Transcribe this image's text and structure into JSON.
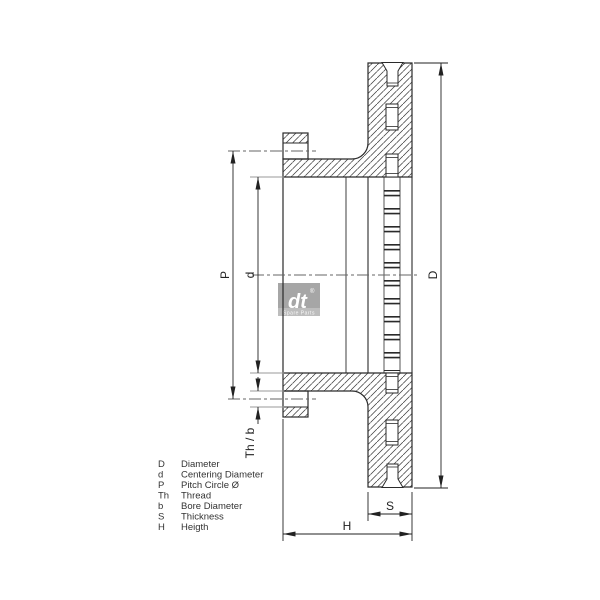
{
  "drawing_type": "brake-disc-cross-section",
  "dimensions": {
    "P": "P",
    "d": "d",
    "D": "D",
    "ThB": "Th / b",
    "S": "S",
    "H": "H"
  },
  "legend": {
    "rows": [
      {
        "key": "D",
        "label": "Diameter"
      },
      {
        "key": "d",
        "label": "Centering Diameter"
      },
      {
        "key": "P",
        "label": "Pitch Circle Ø"
      },
      {
        "key": "Th",
        "label": "Thread"
      },
      {
        "key": "b",
        "label": "Bore Diameter"
      },
      {
        "key": "S",
        "label": "Thickness"
      },
      {
        "key": "H",
        "label": "Heigth"
      }
    ]
  },
  "logo": {
    "text": "dt",
    "registered": "®",
    "caption": "Spare Parts"
  },
  "colors": {
    "outline": "#2a2a2a",
    "dimension": "#222222",
    "extension": "#9a9a9a",
    "centerline": "#666666",
    "hatch": "#3a3a3a",
    "logo_gray": "#a6a6a6",
    "logo_band": "#bdbdbd",
    "background": "#ffffff"
  }
}
